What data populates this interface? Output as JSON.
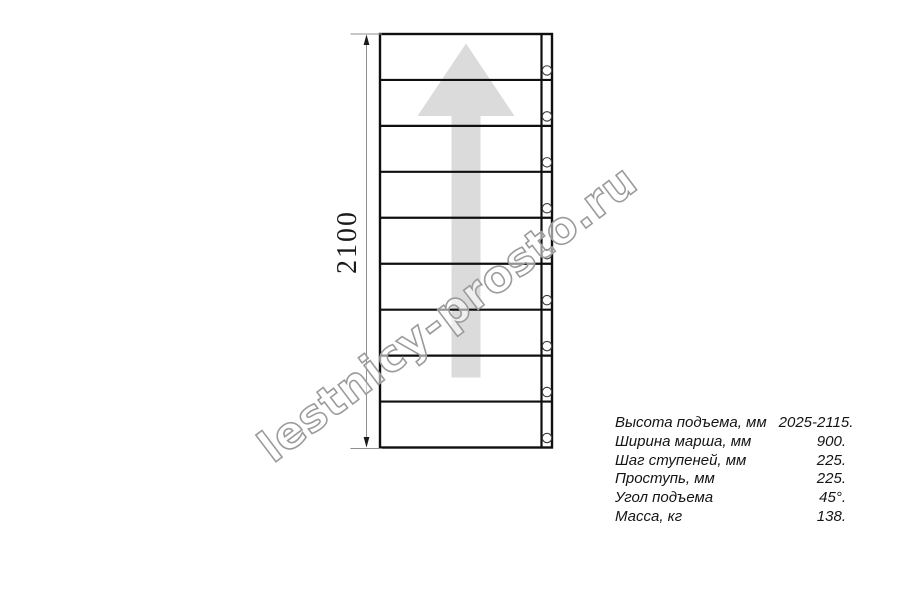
{
  "watermark": {
    "text": "lestnicy-prosto.ru"
  },
  "drawing": {
    "dimension_label": "2100",
    "step_count": 9,
    "direction": "up",
    "colors": {
      "line": "#0f0f0f",
      "arrow_fill": "#dbdbdb",
      "dimension_line": "#8f8f8f",
      "dimension_arrowhead": "#1a1a1a",
      "bolt_stroke": "#3c3c3c",
      "watermark": "#9b9b9b"
    }
  },
  "spec_table": {
    "rows": [
      {
        "label": "Высота подъема, мм",
        "value": "2025-2115."
      },
      {
        "label": "Ширина марша, мм",
        "value": "900."
      },
      {
        "label": "Шаг ступеней, мм",
        "value": "225."
      },
      {
        "label": "Проступь, мм",
        "value": "225."
      },
      {
        "label": "Угол подъема",
        "value": "45°."
      },
      {
        "label": "Масса, кг",
        "value": "138."
      }
    ]
  }
}
